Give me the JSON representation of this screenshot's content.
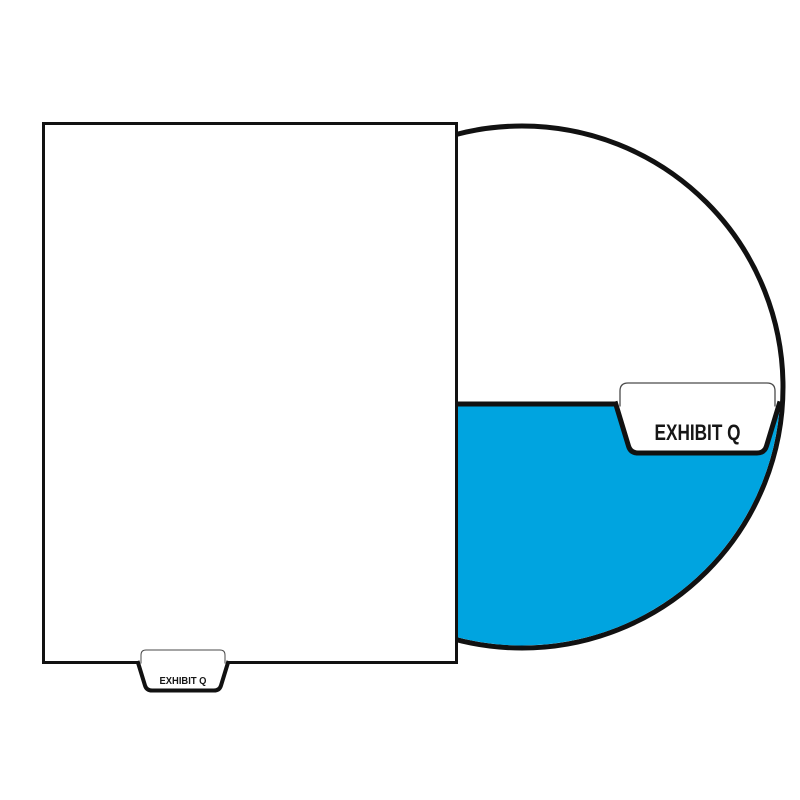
{
  "illustration": {
    "sheet": {
      "tab_label": "EXHIBIT Q"
    },
    "magnifier": {
      "tab_label": "EXHIBIT Q"
    },
    "colors": {
      "divider_blue": "#00A4E0",
      "outline_black": "#111111",
      "thin_outline_gray": "#4a4a4a",
      "paper_white": "#ffffff"
    }
  }
}
